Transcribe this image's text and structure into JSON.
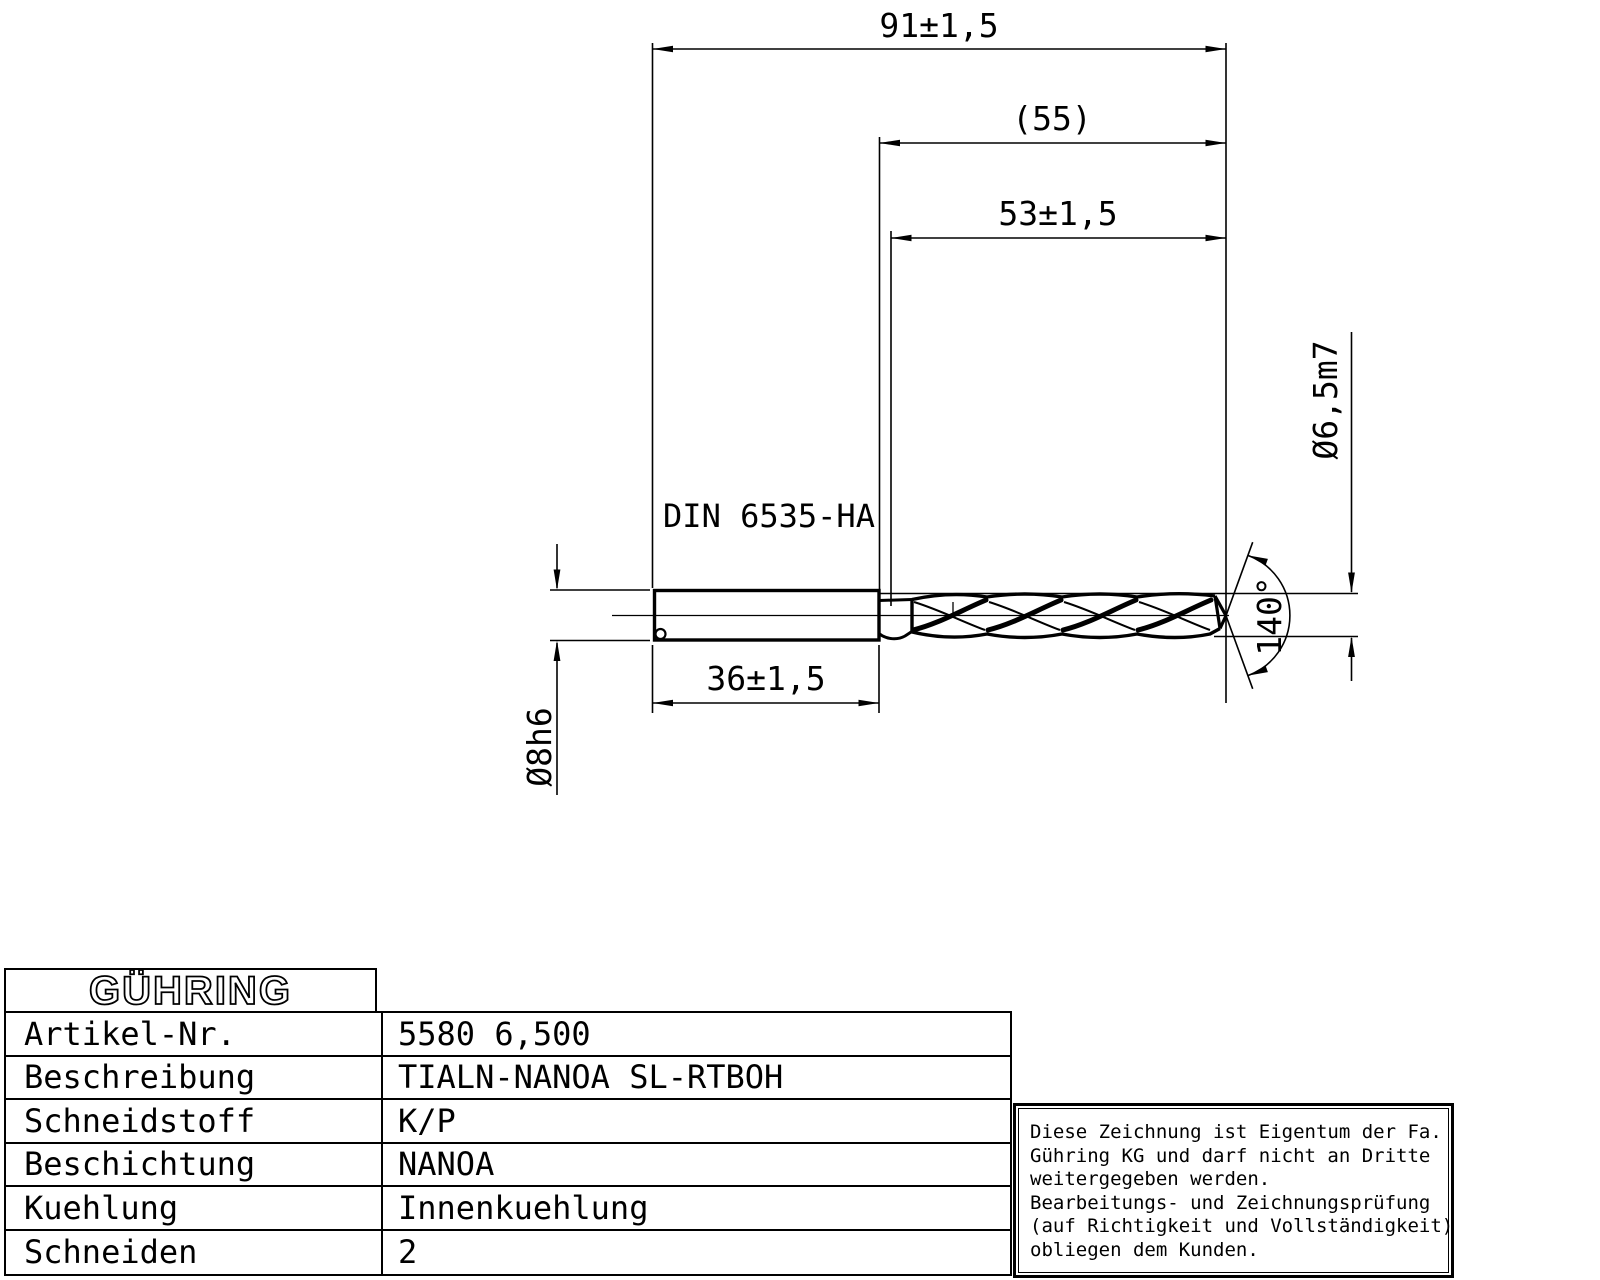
{
  "drawing": {
    "din_label": "DIN 6535-HA",
    "dims": {
      "total_length": "91±1,5",
      "flute_ref": "(55)",
      "flute_length": "53±1,5",
      "shank_length": "36±1,5",
      "shank_dia": "Ø8h6",
      "drill_dia": "Ø6,5m7",
      "point_angle": "140°"
    }
  },
  "table": {
    "logo": "GÜHRING",
    "rows": [
      {
        "label": "Artikel-Nr.",
        "value": "5580 6,500"
      },
      {
        "label": "Beschreibung",
        "value": "TIALN-NANOA SL-RTBOH"
      },
      {
        "label": "Schneidstoff",
        "value": "K/P"
      },
      {
        "label": "Beschichtung",
        "value": "NANOA"
      },
      {
        "label": "Kuehlung",
        "value": "Innenkuehlung"
      },
      {
        "label": "Schneiden",
        "value": "2"
      }
    ]
  },
  "note": {
    "lines": [
      "Diese Zeichnung ist Eigentum der Fa.",
      "Gühring KG und darf nicht an Dritte",
      "weitergegeben werden.",
      "Bearbeitungs- und Zeichnungsprüfung",
      "(auf Richtigkeit und Vollständigkeit)",
      "obliegen dem Kunden."
    ]
  }
}
